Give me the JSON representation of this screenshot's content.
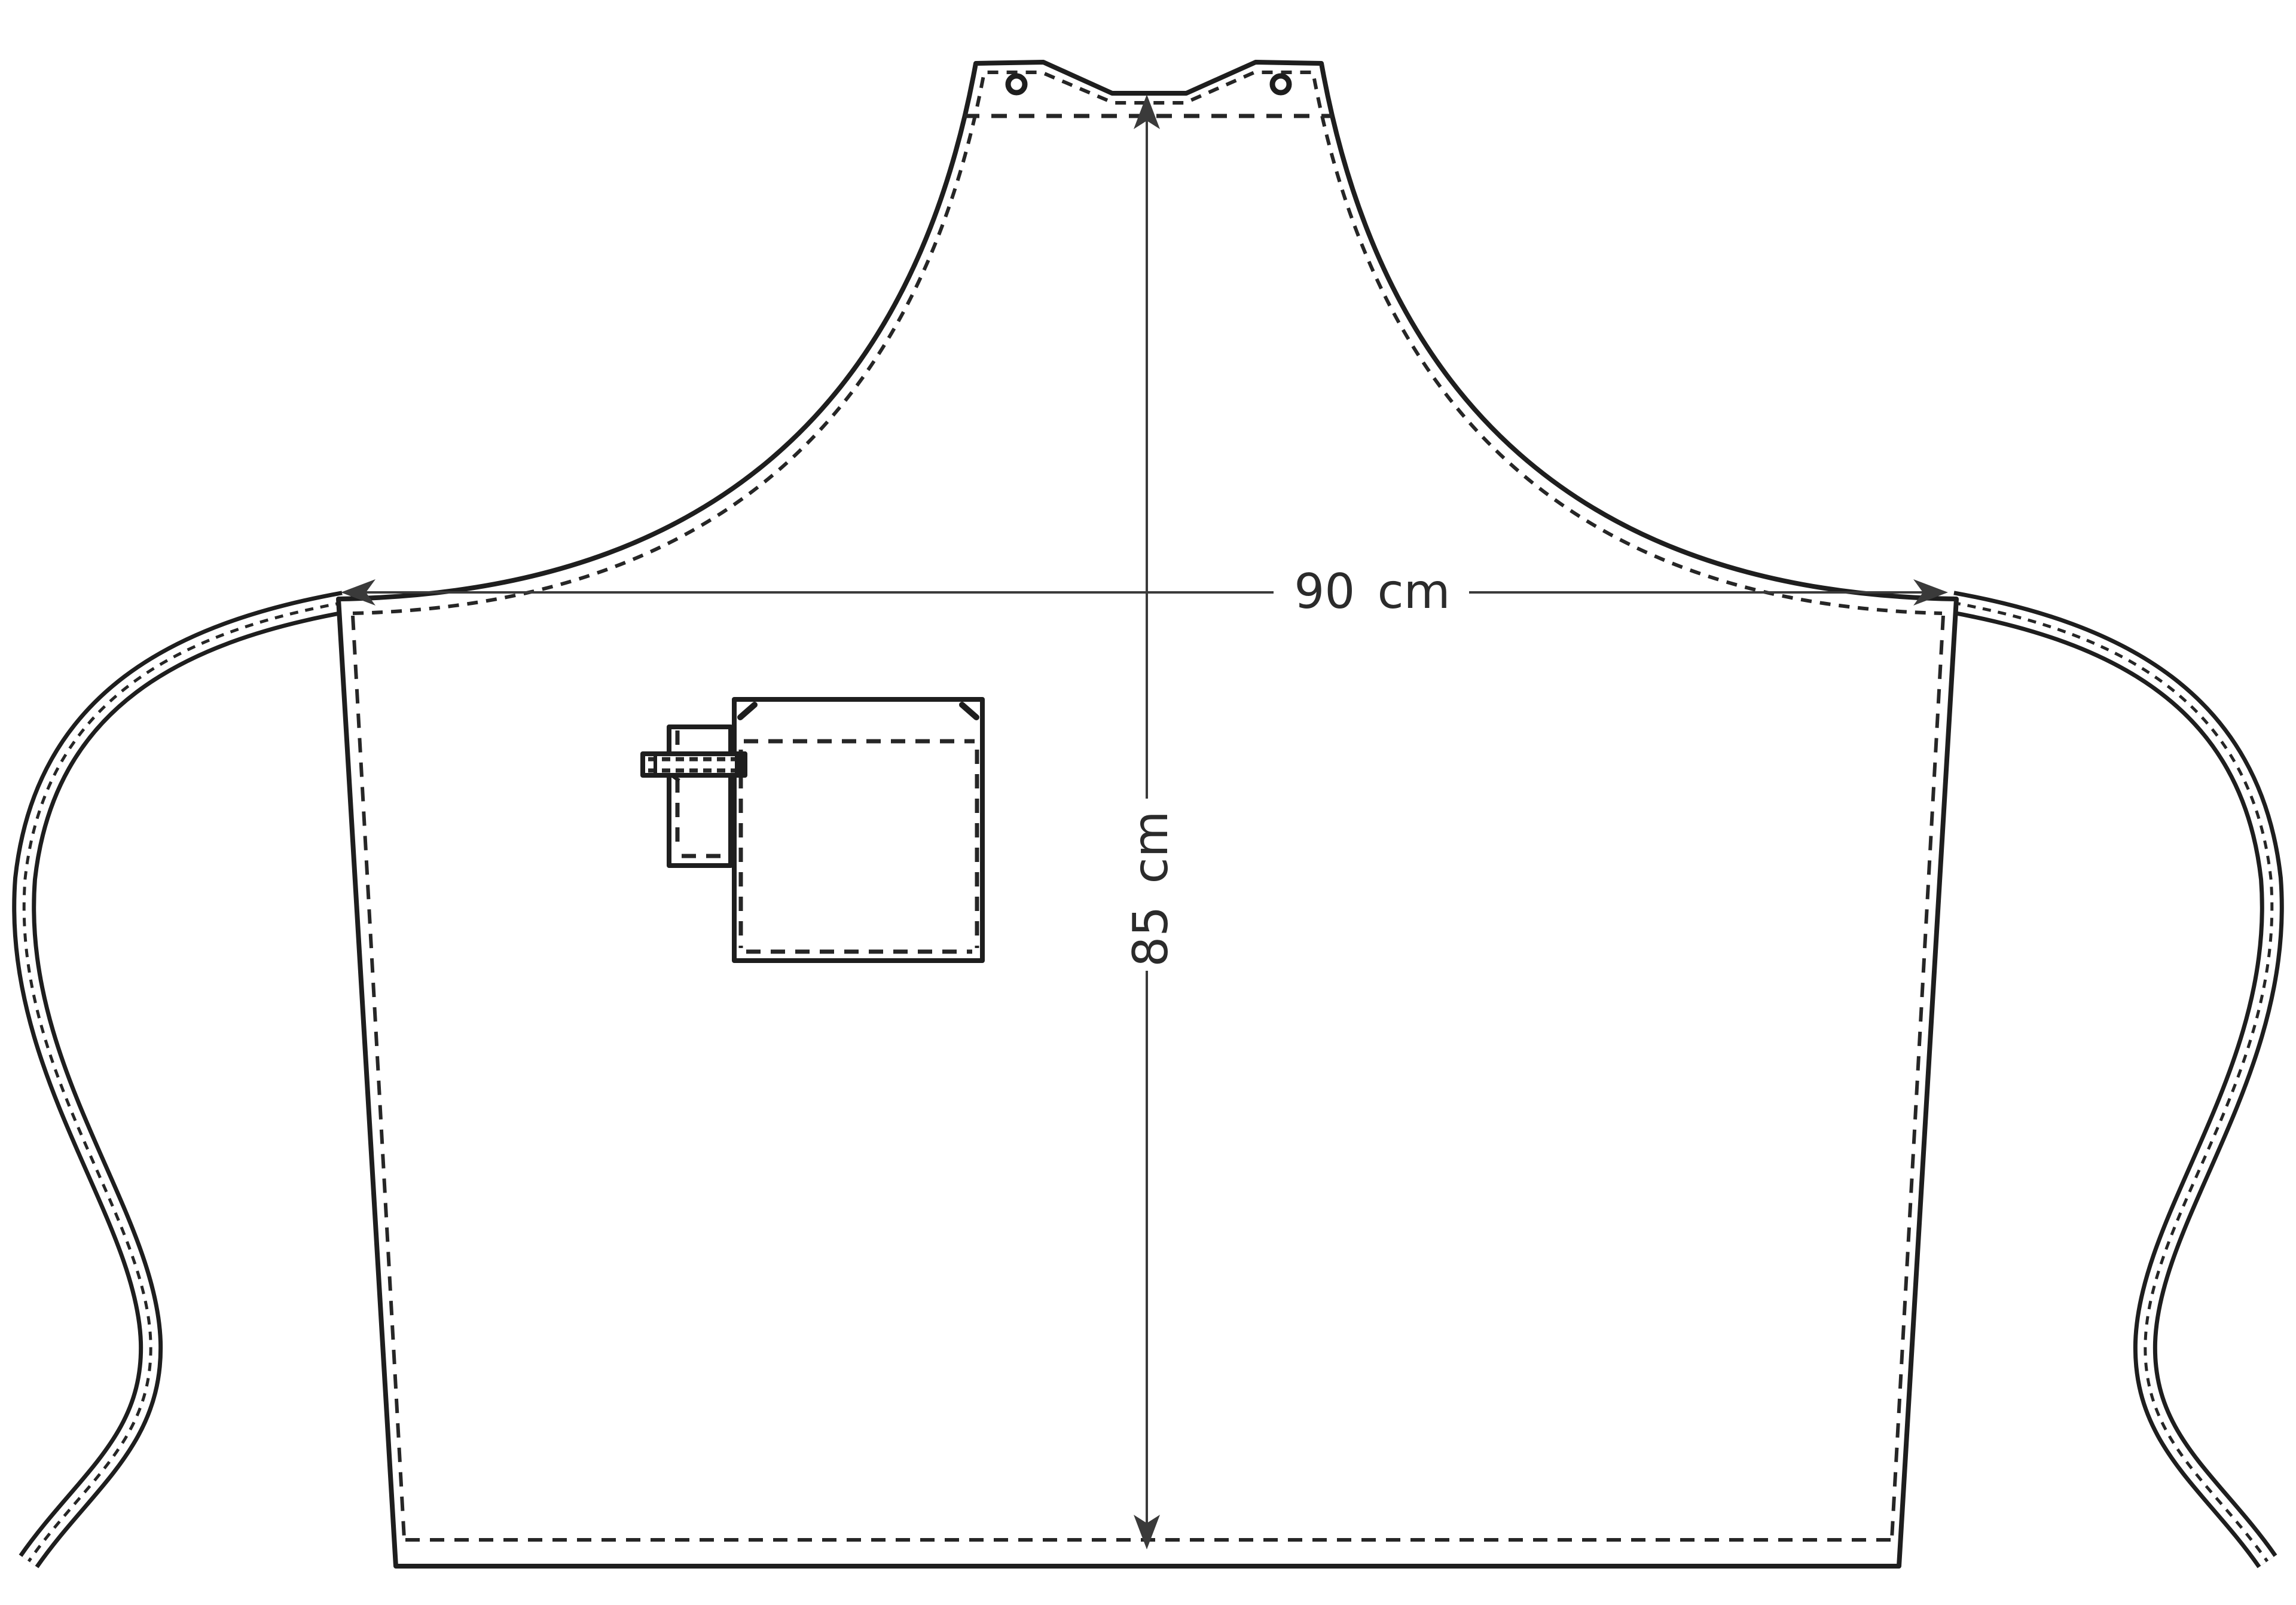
{
  "diagram": {
    "kind": "apron-technical-drawing",
    "dimensions": {
      "width": {
        "label": "90 cm",
        "value": 90,
        "unit": "cm"
      },
      "height": {
        "label": "85 cm",
        "value": 85,
        "unit": "cm"
      }
    },
    "colors": {
      "background": "#ffffff",
      "outline": "#1e1e1e",
      "stitch": "#262626",
      "dimension_line": "#3a3a3a",
      "text": "#2b2b2b"
    },
    "features": {
      "grommets": 2,
      "pocket": "chest-pocket-with-hem-stitching",
      "loop": "towel-loop-with-strap",
      "ties": "left-and-right-waist-ties",
      "stitching": "dashed-seam-and-hem-lines"
    }
  }
}
